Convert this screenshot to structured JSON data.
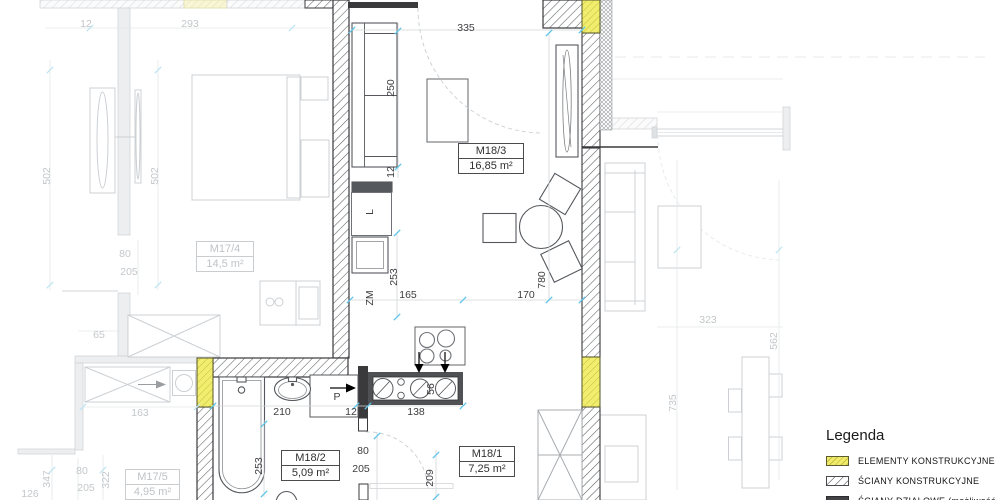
{
  "legend": {
    "title": "Legenda",
    "items": [
      {
        "label": "ELEMENTY KONSTRUKCYJNE"
      },
      {
        "label": "ŚCIANY KONSTRUKCYJNE"
      },
      {
        "label": "ŚCIANY DZIAŁOWE (możliwość"
      }
    ]
  },
  "rooms": {
    "m17_4": {
      "id": "M17/4",
      "area": "14,5 m²"
    },
    "m18_3": {
      "id": "M18/3",
      "area": "16,85 m²"
    },
    "m17_5": {
      "id": "M17/5",
      "area": "4,95 m²"
    },
    "m18_2": {
      "id": "M18/2",
      "area": "5,09 m²"
    },
    "m18_1": {
      "id": "M18/1",
      "area": "7,25 m²"
    }
  },
  "markers": {
    "fridge_l": "L",
    "dishwasher_zm": "ZM",
    "washer_p": "P"
  },
  "dims": {
    "top_width_335": "335",
    "top_left_12": "12",
    "top_left_293": "293",
    "left_502_a": "502",
    "left_502_b": "502",
    "sofa_250": "250",
    "sofa_wall_12": "12",
    "column_253": "253",
    "kitchen_165": "165",
    "kitchen_170": "170",
    "room_depth_780": "780",
    "bed_80": "80",
    "bed_205": "205",
    "wall_65": "65",
    "wardrobe_163": "163",
    "bath_width_210": "210",
    "bath_wall_12": "12",
    "counter_138": "138",
    "sink_56": "56",
    "bath_depth_253": "253",
    "hall_door_80": "80",
    "hall_door_205": "205",
    "hall_209": "209",
    "left_347": "347",
    "left_126": "126",
    "left_80": "80",
    "left_205": "205",
    "left_322": "322",
    "right_323": "323",
    "right_562": "562",
    "right_735": "735"
  }
}
